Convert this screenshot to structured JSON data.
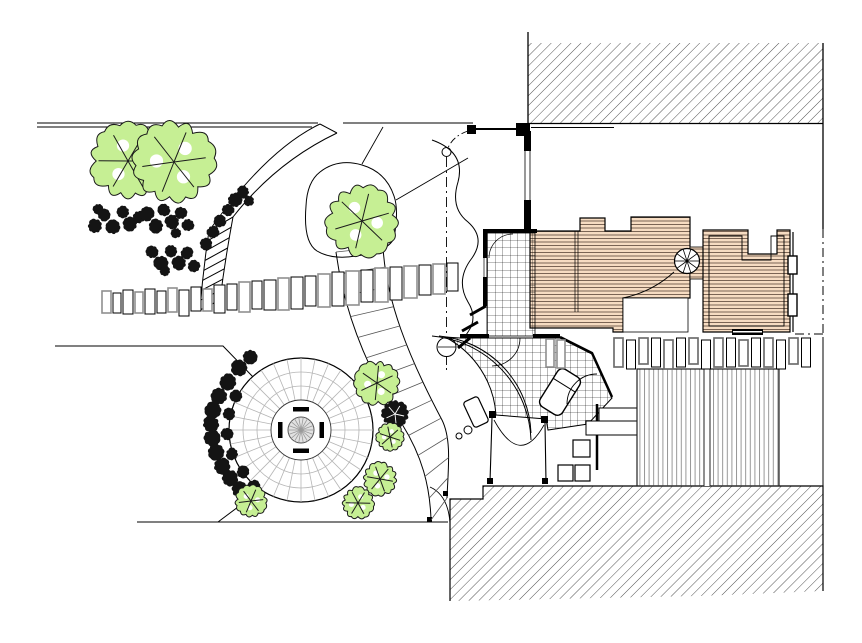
{
  "document": {
    "type": "landscape-site-plan",
    "description": "CAD-style garden / site plan top view: house with terracotta roofs at centre-right, hatched neighbouring buildings top-right and bottom-right, circular paved patio with central table lower-left, curved paths, stepping-stone row, timber deck, trees and shrubs",
    "visible_text": ""
  },
  "colors": {
    "paper": "#ffffff",
    "ink": "#000000",
    "joint_gray": "#b5b5b5",
    "silver": "#8f8f8f",
    "roof_fill": "#f6dcc2",
    "roof_line": "#5a4638",
    "tree_green": "#c6ef94",
    "shrub_ink": "#141414",
    "hatch_ink": "#3f3f3f",
    "deck_line": "#8c8c8c",
    "table_gray": "#9a9a9a"
  },
  "plan": {
    "features": [
      "north-neighbor-building-hatch",
      "south-neighbor-building-hatch",
      "main-house-roof",
      "annex-roof",
      "spiral-stair",
      "tiled-terrace",
      "fan-terrace-rim",
      "timber-deck",
      "paver-row",
      "circular-patio",
      "patio-table-and-benches",
      "crescent-path",
      "garden-steps",
      "stepping-stone-row",
      "banded-walkway",
      "tree-planting-bed",
      "boundary-lines",
      "setback-dashdot-line",
      "garden-gate"
    ],
    "trees": [
      {
        "x": 128,
        "y": 161,
        "r": 36,
        "kind": "green"
      },
      {
        "x": 174,
        "y": 162,
        "r": 39,
        "kind": "green"
      },
      {
        "x": 362,
        "y": 221,
        "r": 34,
        "kind": "green"
      },
      {
        "x": 377,
        "y": 383,
        "r": 21,
        "kind": "green"
      },
      {
        "x": 395,
        "y": 414,
        "r": 13,
        "kind": "dark"
      },
      {
        "x": 390,
        "y": 437,
        "r": 13,
        "kind": "green"
      },
      {
        "x": 380,
        "y": 479,
        "r": 16,
        "kind": "green"
      },
      {
        "x": 358,
        "y": 503,
        "r": 15,
        "kind": "green"
      },
      {
        "x": 251,
        "y": 501,
        "r": 15,
        "kind": "green"
      }
    ],
    "shrubs": [
      [
        95,
        226,
        7
      ],
      [
        104,
        215,
        6
      ],
      [
        113,
        227,
        7
      ],
      [
        123,
        212,
        6
      ],
      [
        130,
        224,
        7
      ],
      [
        139,
        217,
        6
      ],
      [
        98,
        209,
        5
      ],
      [
        147,
        214,
        7
      ],
      [
        156,
        226,
        7
      ],
      [
        164,
        210,
        6
      ],
      [
        172,
        222,
        7
      ],
      [
        181,
        213,
        6
      ],
      [
        188,
        225,
        6
      ],
      [
        176,
        233,
        5
      ],
      [
        152,
        252,
        6
      ],
      [
        161,
        263,
        7
      ],
      [
        171,
        251,
        6
      ],
      [
        179,
        263,
        7
      ],
      [
        187,
        253,
        6
      ],
      [
        194,
        266,
        6
      ],
      [
        165,
        271,
        5
      ],
      [
        206,
        244,
        6
      ],
      [
        213,
        232,
        6
      ],
      [
        220,
        221,
        6
      ],
      [
        228,
        210,
        6
      ],
      [
        235,
        200,
        7
      ],
      [
        243,
        192,
        6
      ],
      [
        249,
        201,
        5
      ],
      [
        250,
        357,
        7
      ],
      [
        239,
        368,
        8
      ],
      [
        228,
        382,
        8
      ],
      [
        219,
        396,
        8
      ],
      [
        213,
        410,
        8
      ],
      [
        211,
        424,
        8
      ],
      [
        212,
        438,
        8
      ],
      [
        216,
        452,
        8
      ],
      [
        222,
        466,
        8
      ],
      [
        230,
        478,
        8
      ],
      [
        240,
        490,
        8
      ],
      [
        250,
        500,
        7
      ],
      [
        236,
        396,
        6
      ],
      [
        229,
        414,
        6
      ],
      [
        227,
        434,
        6
      ],
      [
        232,
        454,
        6
      ],
      [
        243,
        472,
        6
      ],
      [
        254,
        486,
        6
      ]
    ],
    "flagstones": [
      [
        102,
        291,
        9,
        22,
        "s"
      ],
      [
        113,
        293,
        8,
        20,
        "k"
      ],
      [
        123,
        290,
        10,
        24,
        "k"
      ],
      [
        135,
        292,
        8,
        21,
        "s"
      ],
      [
        145,
        289,
        10,
        25,
        "k"
      ],
      [
        157,
        291,
        9,
        22,
        "k"
      ],
      [
        168,
        288,
        9,
        24,
        "s"
      ],
      [
        179,
        290,
        10,
        26,
        "k"
      ],
      [
        191,
        287,
        10,
        24,
        "k"
      ],
      [
        203,
        289,
        9,
        22,
        "s"
      ],
      [
        214,
        285,
        11,
        28,
        "k"
      ],
      [
        227,
        284,
        10,
        26,
        "k"
      ],
      [
        239,
        282,
        11,
        30,
        "s"
      ],
      [
        252,
        281,
        10,
        28,
        "k"
      ],
      [
        264,
        280,
        12,
        30,
        "k"
      ],
      [
        278,
        278,
        11,
        32,
        "s"
      ],
      [
        291,
        277,
        12,
        32,
        "k"
      ],
      [
        305,
        276,
        11,
        30,
        "k"
      ],
      [
        318,
        274,
        12,
        33,
        "s"
      ],
      [
        332,
        272,
        12,
        34,
        "k"
      ],
      [
        346,
        271,
        13,
        34,
        "s"
      ],
      [
        361,
        270,
        12,
        32,
        "k"
      ],
      [
        375,
        268,
        13,
        34,
        "s"
      ],
      [
        390,
        267,
        12,
        33,
        "k"
      ],
      [
        404,
        266,
        13,
        32,
        "s"
      ],
      [
        419,
        265,
        12,
        30,
        "k"
      ],
      [
        433,
        264,
        12,
        30,
        "s"
      ],
      [
        447,
        263,
        11,
        28,
        "k"
      ]
    ],
    "paver_row": {
      "x0": 614,
      "y": 338,
      "count": 16,
      "dx": 12.5,
      "w": 9,
      "h": 29
    },
    "gray_pavers": [
      [
        546,
        339
      ],
      [
        557,
        340
      ]
    ],
    "patio": {
      "cx": 301,
      "cy": 430,
      "r_outer": 72,
      "r_inner": 30,
      "rings": [
        44,
        58
      ],
      "spoke_step_deg": 11.25,
      "table_r": 13,
      "bench_len": 16
    },
    "deck": {
      "x": 637,
      "y": 369,
      "w": 142,
      "h": 117,
      "divider_x": 707
    },
    "hatch_north": {
      "x": 528,
      "y": 43,
      "w": 295,
      "h": 80
    },
    "spiral_stair": {
      "cx": 687,
      "cy": 261,
      "r": 12.5,
      "spokes": 10
    }
  }
}
